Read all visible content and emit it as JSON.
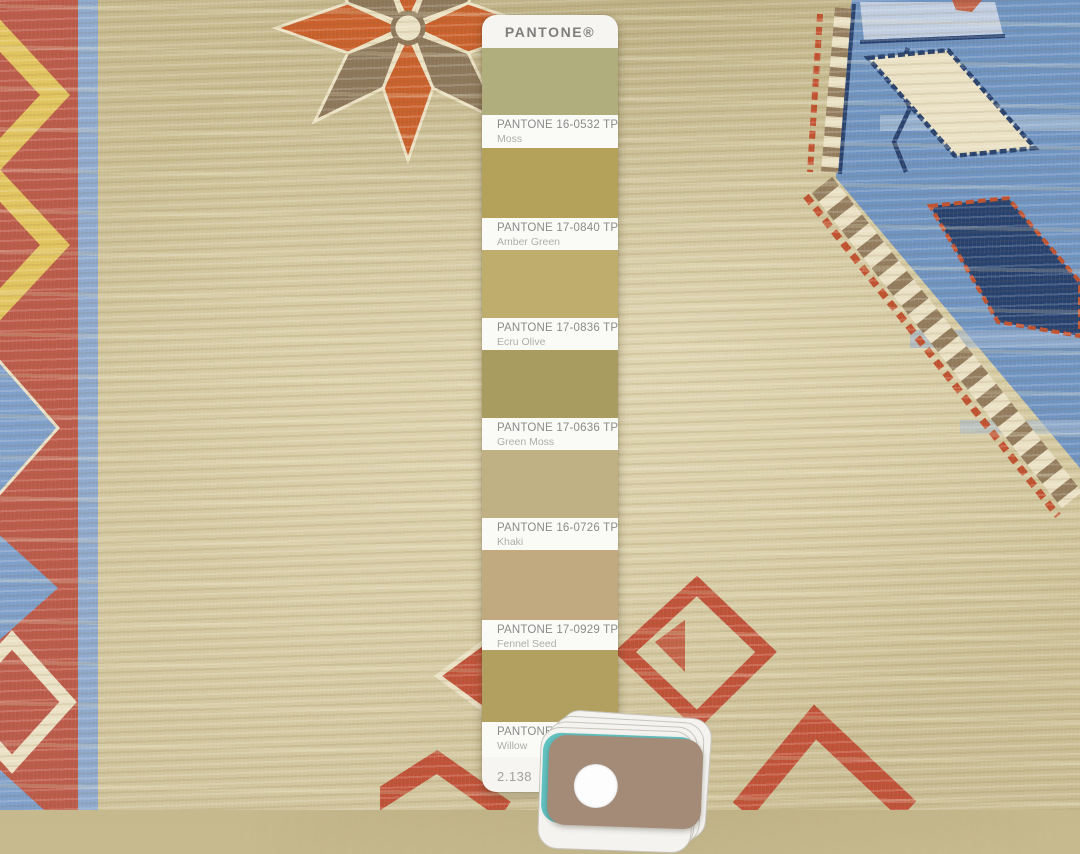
{
  "pantone_card": {
    "brand": "PANTONE®",
    "page_number": "2.138",
    "swatches": [
      {
        "code": "PANTONE 16-0532 TPG",
        "name": "Moss",
        "color": "#b1ae7d"
      },
      {
        "code": "PANTONE 17-0840 TPG",
        "name": "Amber Green",
        "color": "#b4a25a"
      },
      {
        "code": "PANTONE 17-0836 TPG",
        "name": "Ecru Olive",
        "color": "#bead6d"
      },
      {
        "code": "PANTONE 17-0636 TPG",
        "name": "Green Moss",
        "color": "#a89c60"
      },
      {
        "code": "PANTONE 16-0726 TPG",
        "name": "Khaki",
        "color": "#bfb184"
      },
      {
        "code": "PANTONE 17-0929 TPG",
        "name": "Fennel Seed",
        "color": "#c2aa80"
      },
      {
        "code": "PANTONE 16-06",
        "name": "Willow",
        "color": "#b2a061"
      }
    ]
  },
  "colors": {
    "card_white": "#f7f5f1",
    "brand_gray": "#7e7e7e",
    "label_code": "#8b8b8b",
    "label_name": "#adadad",
    "page_gray": "#a2a2a0",
    "border_red": "#bc5a49",
    "accent_yellow": "#e2c45e",
    "guard_blue": "#8fa9cc",
    "motif_blue": "#7e9fc9",
    "medallion_blue": "#6f93c0",
    "navy": "#27416f",
    "cream": "#eae0c4",
    "stripe_brown": "#937c5d",
    "serrated_red": "#c1512f",
    "motif_red": "#c05138",
    "star_orange": "#c95f2b",
    "star_taupe": "#8d775a",
    "deck_card": "#a48b77",
    "deck_teal": "#63c3c3"
  }
}
